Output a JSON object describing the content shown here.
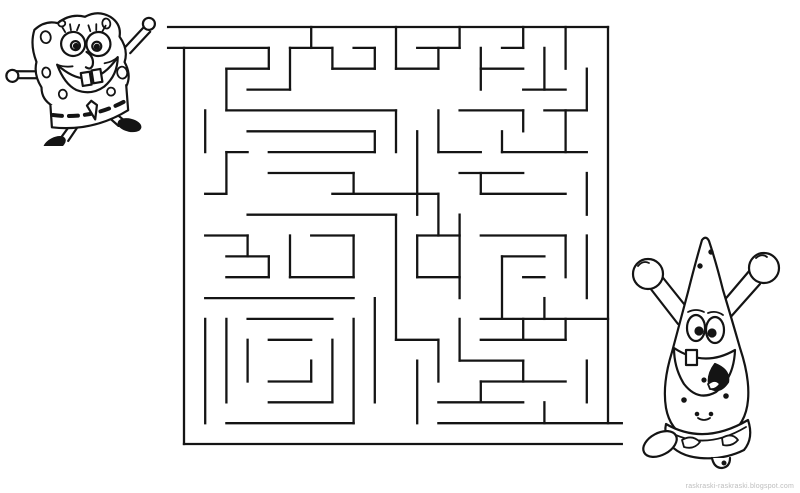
{
  "page": {
    "background": "#ffffff",
    "watermark": "raskraski-raskraski.blogspot.com",
    "watermark_color": "#bdbdbd"
  },
  "puzzle": {
    "type": "maze",
    "theme": "SpongeBob SquarePants coloring-page maze",
    "characters": [
      {
        "id": "spongebob",
        "label": "SpongeBob running (start of maze)",
        "position": "top-left"
      },
      {
        "id": "patrick",
        "label": "Patrick cheering (end of maze)",
        "position": "bottom-right"
      }
    ],
    "maze": {
      "cols": 20,
      "rows": 20,
      "origin": {
        "x": 184,
        "y": 27
      },
      "cell": {
        "w": 21.2,
        "h": 20.85
      },
      "ink": "#141414",
      "stroke_width": 2.3,
      "entrance": {
        "side": "left",
        "at_row": 0
      },
      "exit": {
        "side": "right",
        "at_row": 19
      },
      "walls": [
        [
          -0.75,
          0,
          20,
          0
        ],
        [
          -0.75,
          1,
          4,
          1
        ],
        [
          0,
          1,
          0,
          20
        ],
        [
          0,
          20,
          20.65,
          20
        ],
        [
          20,
          0,
          20,
          19
        ],
        [
          12,
          19,
          20.65,
          19
        ],
        [
          4,
          1,
          4,
          2
        ],
        [
          2,
          2,
          4,
          2
        ],
        [
          2,
          2,
          2,
          4
        ],
        [
          3,
          3,
          5,
          3
        ],
        [
          5,
          1,
          5,
          3
        ],
        [
          6,
          0,
          6,
          1
        ],
        [
          5,
          1,
          7,
          1
        ],
        [
          7,
          1,
          7,
          2
        ],
        [
          7,
          2,
          9,
          2
        ],
        [
          9,
          1,
          9,
          2
        ],
        [
          8,
          1,
          9,
          1
        ],
        [
          10,
          0,
          10,
          2
        ],
        [
          10,
          2,
          12,
          2
        ],
        [
          12,
          1,
          12,
          2
        ],
        [
          11,
          1,
          13,
          1
        ],
        [
          13,
          0,
          13,
          1
        ],
        [
          14,
          1,
          14,
          3
        ],
        [
          14,
          2,
          16,
          2
        ],
        [
          16,
          0,
          16,
          1
        ],
        [
          15,
          1,
          16,
          1
        ],
        [
          17,
          1,
          17,
          3
        ],
        [
          16,
          3,
          18,
          3
        ],
        [
          18,
          0,
          18,
          2
        ],
        [
          19,
          2,
          19,
          4
        ],
        [
          2,
          4,
          10,
          4
        ],
        [
          3,
          5,
          9,
          5
        ],
        [
          9,
          5,
          9,
          6
        ],
        [
          4,
          6,
          9,
          6
        ],
        [
          2,
          6,
          3,
          6
        ],
        [
          1,
          4,
          1,
          6
        ],
        [
          2,
          6,
          2,
          8
        ],
        [
          1,
          8,
          2,
          8
        ],
        [
          4,
          7,
          8,
          7
        ],
        [
          8,
          7,
          8,
          8
        ],
        [
          10,
          4,
          10,
          6
        ],
        [
          7,
          8,
          12,
          8
        ],
        [
          3,
          9,
          10,
          9
        ],
        [
          10,
          9,
          10,
          15
        ],
        [
          11,
          5,
          11,
          9
        ],
        [
          12,
          6,
          14,
          6
        ],
        [
          12,
          4,
          12,
          6
        ],
        [
          13,
          7,
          16,
          7
        ],
        [
          14,
          7,
          14,
          8
        ],
        [
          14,
          8,
          18,
          8
        ],
        [
          12,
          8,
          12,
          10
        ],
        [
          13,
          4,
          16,
          4
        ],
        [
          16,
          4,
          16,
          5
        ],
        [
          17,
          4,
          19,
          4
        ],
        [
          18,
          4,
          18,
          6
        ],
        [
          15,
          6,
          19,
          6
        ],
        [
          15,
          5,
          15,
          6
        ],
        [
          19,
          7,
          19,
          9
        ],
        [
          14,
          10,
          18,
          10
        ],
        [
          18,
          10,
          18,
          12
        ],
        [
          15,
          11,
          17,
          11
        ],
        [
          15,
          11,
          15,
          14
        ],
        [
          19,
          10,
          19,
          13
        ],
        [
          13,
          9,
          13,
          13
        ],
        [
          16,
          12,
          17,
          12
        ],
        [
          14,
          14,
          20,
          14
        ],
        [
          17,
          13,
          17,
          14
        ],
        [
          16,
          14,
          16,
          15
        ],
        [
          18,
          14,
          18,
          15
        ],
        [
          14,
          15,
          18,
          15
        ],
        [
          13,
          14,
          13,
          16
        ],
        [
          1,
          10,
          3,
          10
        ],
        [
          3,
          10,
          3,
          11
        ],
        [
          2,
          11,
          4,
          11
        ],
        [
          4,
          11,
          4,
          12
        ],
        [
          2,
          12,
          4,
          12
        ],
        [
          5,
          10,
          5,
          12
        ],
        [
          5,
          12,
          8,
          12
        ],
        [
          6,
          10,
          8,
          10
        ],
        [
          8,
          10,
          8,
          12
        ],
        [
          11,
          10,
          11,
          12
        ],
        [
          11,
          12,
          13,
          12
        ],
        [
          11,
          10,
          13,
          10
        ],
        [
          1,
          13,
          8,
          13
        ],
        [
          1,
          14,
          1,
          19
        ],
        [
          8,
          14,
          8,
          19
        ],
        [
          2,
          19,
          8,
          19
        ],
        [
          2,
          14,
          2,
          18
        ],
        [
          3,
          14,
          7,
          14
        ],
        [
          7,
          15,
          7,
          18
        ],
        [
          4,
          18,
          7,
          18
        ],
        [
          3,
          15,
          3,
          17
        ],
        [
          4,
          15,
          6,
          15
        ],
        [
          6,
          16,
          6,
          17
        ],
        [
          4,
          17,
          6,
          17
        ],
        [
          9,
          13,
          9,
          18
        ],
        [
          10,
          15,
          12,
          15
        ],
        [
          12,
          15,
          12,
          17
        ],
        [
          11,
          16,
          11,
          19
        ],
        [
          13,
          16,
          16,
          16
        ],
        [
          16,
          16,
          16,
          17
        ],
        [
          14,
          17,
          18,
          17
        ],
        [
          14,
          17,
          14,
          18
        ],
        [
          12,
          18,
          16,
          18
        ],
        [
          17,
          18,
          17,
          19
        ],
        [
          19,
          16,
          19,
          18
        ]
      ]
    }
  }
}
